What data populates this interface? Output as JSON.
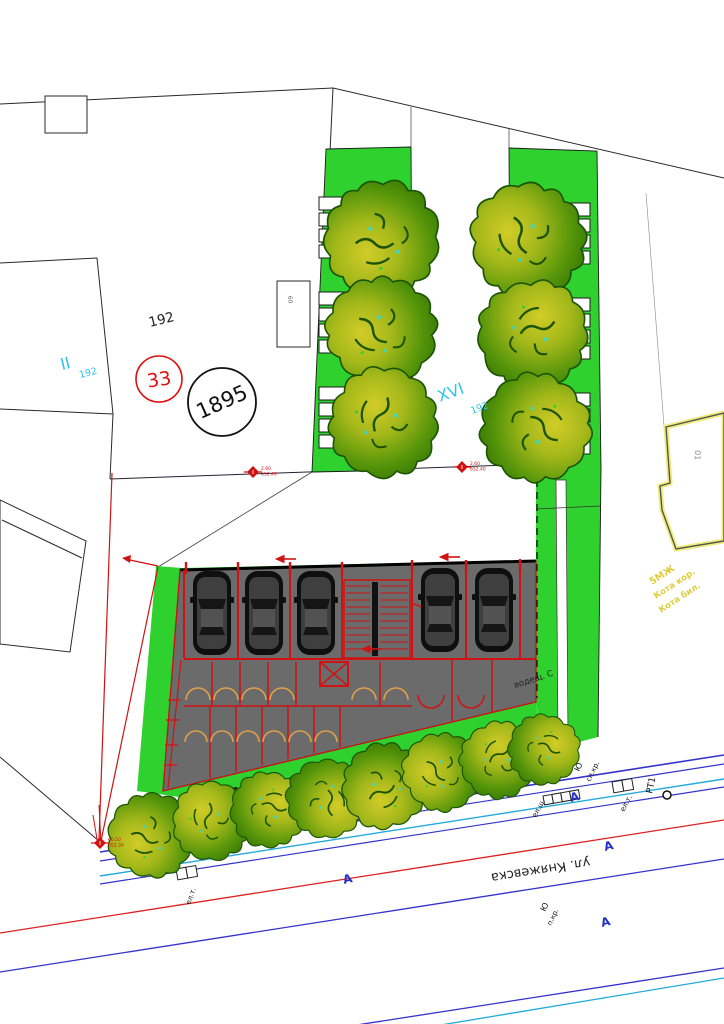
{
  "plan": {
    "parcels": {
      "p192": "192",
      "ii_main": "II",
      "ii_sub": "192",
      "xvi_main": "XVI",
      "xvi_sub": "192",
      "circle33": "33",
      "circle1895": "1895",
      "small_building_label": "60",
      "neighbor_building_label": "01"
    },
    "notes": {
      "building_type": "5МЖ",
      "kota_kor": "Кота кор.",
      "kota_bil": "Кота бил.",
      "green_note": "водещ. С"
    },
    "street": {
      "name": "ул. Княжевска",
      "symbols": {
        "el_sh": "ел.ш.",
        "el_t_right": "ел.т.",
        "el_t_left": "ел.т.",
        "sp_kr": "сп.кр.",
        "yu_top": "Ю",
        "rt1": "РТ1",
        "yu_bottom": "Ю",
        "p_kr": "п.кр.",
        "arrow_a1": "А",
        "arrow_a2": "А",
        "arrow_a3": "А",
        "arrow_a4": "А"
      }
    },
    "elevations": {
      "m1a": "2.60",
      "m1b": "652.40",
      "m2a": "2.60",
      "m2b": "652.40",
      "m3a": "60.50",
      "m3b": "652.30"
    },
    "colors": {
      "green": "#2ed12e",
      "building_gray": "#6b6b6b",
      "wall_red": "#d01212",
      "cyan_label": "#2ec4ea",
      "yellow_label": "#e0cc3a",
      "street_blue": "#3333cc",
      "street_cyan": "#22aadd",
      "street_red": "#dd2222"
    }
  }
}
